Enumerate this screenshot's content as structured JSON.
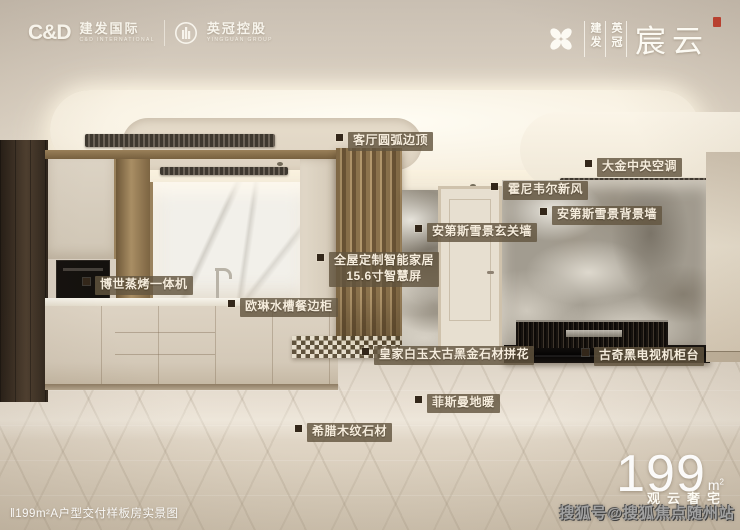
{
  "header": {
    "cd_logo": "C&D",
    "cd_name": "建发国际",
    "cd_sub": "C&D INTERNATIONAL",
    "yg_name": "英冠控股",
    "yg_sub": "YINGGUAN GROUP",
    "vertical_1": "建发",
    "vertical_2": "英冠",
    "project_name": "宸云"
  },
  "callouts": [
    "客厅圆弧边顶",
    "大金中央空调",
    "霍尼韦尔新风",
    "安第斯雪景背景墙",
    "安第斯雪景玄关墙",
    "全屋定制智能家居\n15.6寸智慧屏",
    "博世蒸烤一体机",
    "欧琳水槽餐边柜",
    "皇家白玉太古黑金石材拼花",
    "古奇黑电视机柜台",
    "菲斯曼地暖",
    "希腊木纹石材"
  ],
  "footer": {
    "caption": "‖199m²A户型交付样板房实景图",
    "area_number": "199",
    "area_unit_base": "m",
    "area_unit_sup": "2",
    "tagline": "观云奢宅",
    "watermark": "搜狐号@搜狐焦点随州站"
  },
  "colors": {
    "label_background": "#635540",
    "label_text": "#f5ecdc",
    "bullet": "#33271a",
    "seal_red": "#b8402f",
    "ceiling_cream": "#f8f1e2",
    "gold_trim": "#a98e64",
    "floor_beige": "#ddd2c1"
  }
}
